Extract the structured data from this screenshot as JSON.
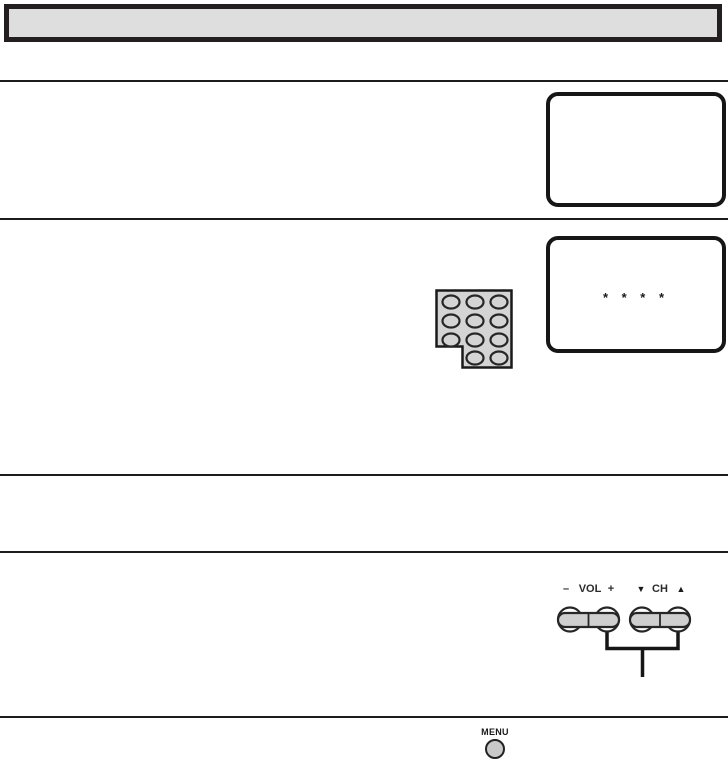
{
  "tv_screens": {
    "screen_password": {
      "text": "* * * *"
    }
  },
  "keypad": {
    "button_rows": [
      3,
      3,
      3,
      2
    ]
  },
  "side_controls": {
    "volume": {
      "minus": "–",
      "label": "VOL",
      "plus": "+"
    },
    "channel": {
      "down": "▼",
      "label": "CH",
      "up": "▲"
    }
  },
  "menu": {
    "label": "MENU"
  },
  "colors": {
    "ink": "#1f1f1f",
    "panel_gray": "#dedede",
    "keypad_gray": "#d4d4d4",
    "button_gray": "#cfcfcf"
  }
}
